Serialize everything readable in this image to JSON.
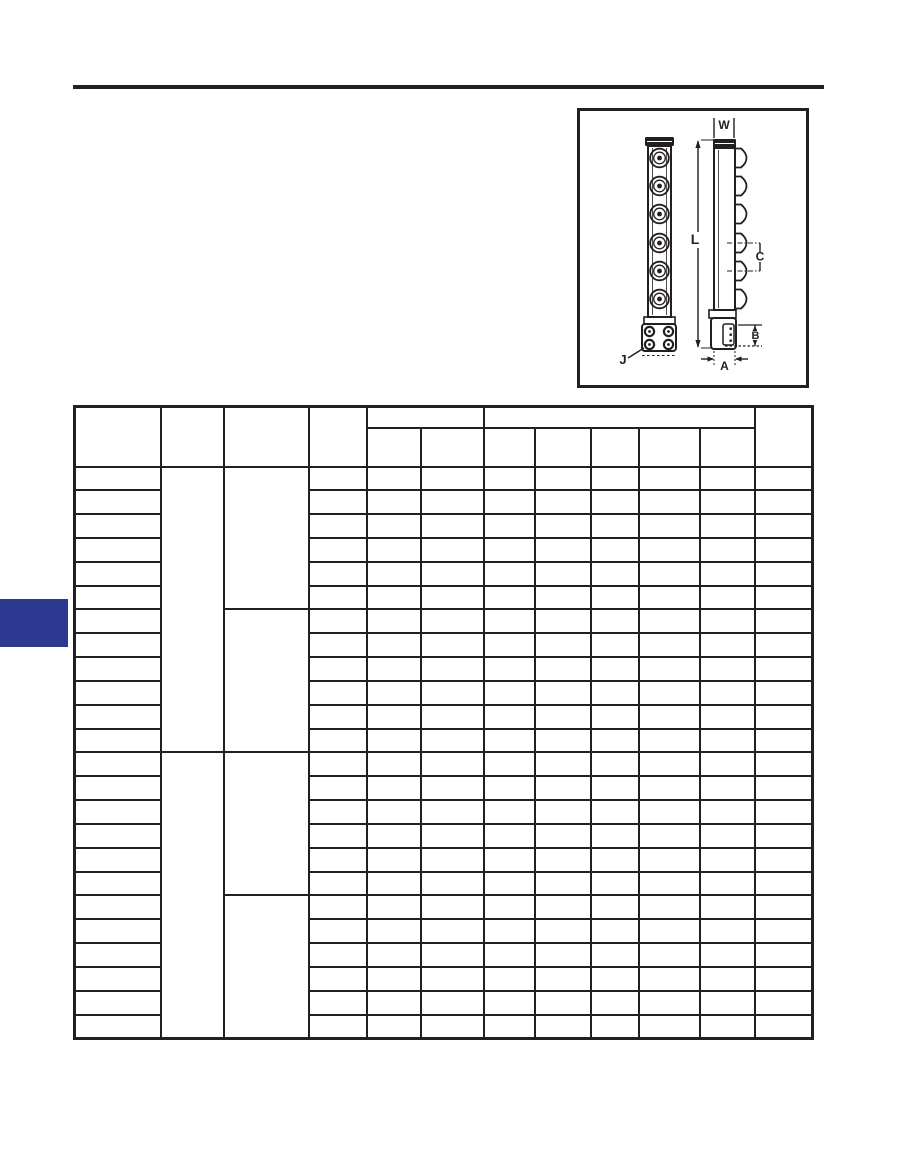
{
  "colors": {
    "ink": "#231f20",
    "tab_blue": "#2b3990",
    "page_bg": "#ffffff"
  },
  "diagram": {
    "labels": {
      "w": "W",
      "l": "L",
      "c": "C",
      "b": "B",
      "a": "A",
      "j": "J"
    }
  },
  "table": {
    "body": {
      "row_count": 24,
      "col_count": 12,
      "merged_columns": {
        "1": 12,
        "2": 6
      }
    }
  }
}
